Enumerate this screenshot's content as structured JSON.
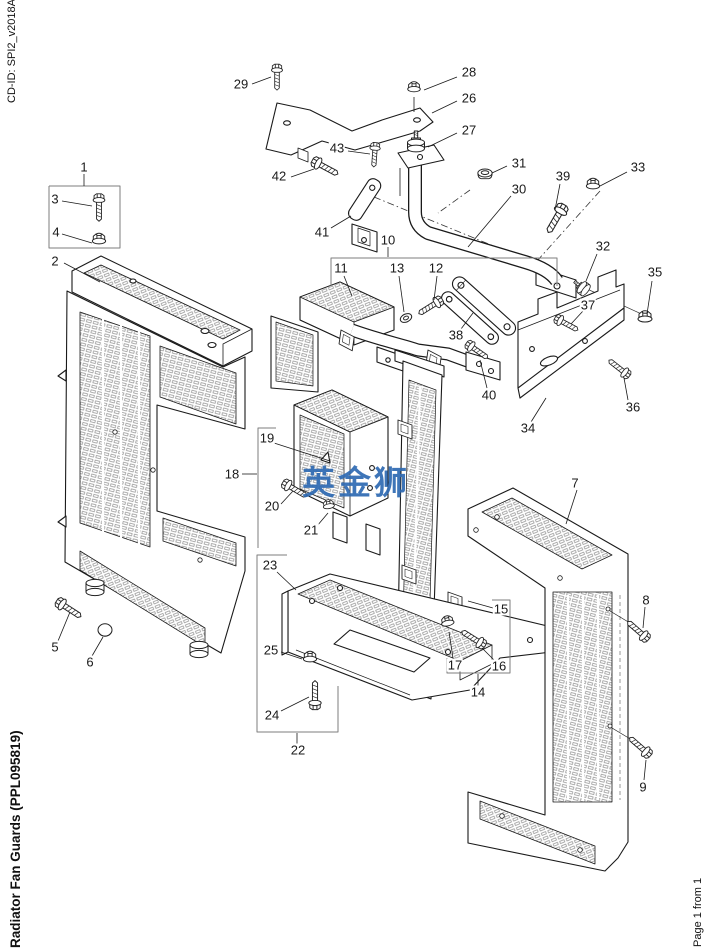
{
  "page": {
    "cd_id": "CD-ID: SPI2_v2018A",
    "title": "Radiator Fan Guards (PPL095819)",
    "page_label": "Page 1 from 1",
    "background": "#ffffff",
    "line_color": "#1a1a1a",
    "box_color": "#7d7d7d"
  },
  "watermark": {
    "text": "英金狮",
    "color": "#2e6ab3"
  },
  "diagram": {
    "description": "Exploded isometric parts diagram of radiator fan guards with numbered callouts 1-43",
    "callouts": [
      {
        "label": "1",
        "x": 84,
        "y": 167
      },
      {
        "label": "2",
        "x": 55,
        "y": 261
      },
      {
        "label": "3",
        "x": 55,
        "y": 199
      },
      {
        "label": "4",
        "x": 56,
        "y": 232
      },
      {
        "label": "5",
        "x": 55,
        "y": 647
      },
      {
        "label": "6",
        "x": 90,
        "y": 662
      },
      {
        "label": "7",
        "x": 575,
        "y": 483
      },
      {
        "label": "8",
        "x": 646,
        "y": 600
      },
      {
        "label": "9",
        "x": 643,
        "y": 787
      },
      {
        "label": "10",
        "x": 388,
        "y": 240
      },
      {
        "label": "11",
        "x": 341,
        "y": 268
      },
      {
        "label": "12",
        "x": 436,
        "y": 268
      },
      {
        "label": "13",
        "x": 397,
        "y": 268
      },
      {
        "label": "14",
        "x": 478,
        "y": 692
      },
      {
        "label": "15",
        "x": 501,
        "y": 609
      },
      {
        "label": "16",
        "x": 499,
        "y": 666
      },
      {
        "label": "17",
        "x": 455,
        "y": 665
      },
      {
        "label": "18",
        "x": 232,
        "y": 474
      },
      {
        "label": "19",
        "x": 267,
        "y": 438
      },
      {
        "label": "20",
        "x": 272,
        "y": 506
      },
      {
        "label": "21",
        "x": 311,
        "y": 530
      },
      {
        "label": "22",
        "x": 298,
        "y": 750
      },
      {
        "label": "23",
        "x": 270,
        "y": 565
      },
      {
        "label": "24",
        "x": 272,
        "y": 715
      },
      {
        "label": "25",
        "x": 271,
        "y": 650
      },
      {
        "label": "26",
        "x": 469,
        "y": 98
      },
      {
        "label": "27",
        "x": 469,
        "y": 130
      },
      {
        "label": "28",
        "x": 469,
        "y": 72
      },
      {
        "label": "29",
        "x": 241,
        "y": 84
      },
      {
        "label": "30",
        "x": 519,
        "y": 189
      },
      {
        "label": "31",
        "x": 519,
        "y": 163
      },
      {
        "label": "32",
        "x": 603,
        "y": 246
      },
      {
        "label": "33",
        "x": 638,
        "y": 167
      },
      {
        "label": "34",
        "x": 528,
        "y": 428
      },
      {
        "label": "35",
        "x": 655,
        "y": 272
      },
      {
        "label": "36",
        "x": 633,
        "y": 407
      },
      {
        "label": "37",
        "x": 588,
        "y": 305
      },
      {
        "label": "38",
        "x": 456,
        "y": 335
      },
      {
        "label": "39",
        "x": 563,
        "y": 176
      },
      {
        "label": "40",
        "x": 489,
        "y": 395
      },
      {
        "label": "41",
        "x": 322,
        "y": 232
      },
      {
        "label": "42",
        "x": 279,
        "y": 176
      },
      {
        "label": "43",
        "x": 337,
        "y": 148
      }
    ],
    "leaders": [
      [
        84,
        174,
        84,
        186
      ],
      [
        64,
        263,
        100,
        282
      ],
      [
        62,
        201,
        92,
        206
      ],
      [
        62,
        234,
        92,
        243
      ],
      [
        58,
        641,
        70,
        612
      ],
      [
        92,
        656,
        103,
        637
      ],
      [
        577,
        490,
        566,
        524
      ],
      [
        645,
        607,
        643,
        628
      ],
      [
        644,
        780,
        646,
        760
      ],
      [
        388,
        247,
        388,
        257
      ],
      [
        344,
        276,
        352,
        296
      ],
      [
        437,
        276,
        434,
        300
      ],
      [
        399,
        276,
        404,
        312
      ],
      [
        478,
        686,
        478,
        674
      ],
      [
        493,
        608,
        468,
        601
      ],
      [
        494,
        660,
        482,
        648
      ],
      [
        453,
        658,
        449,
        632
      ],
      [
        242,
        474,
        257,
        474
      ],
      [
        274,
        443,
        330,
        461
      ],
      [
        281,
        504,
        293,
        491
      ],
      [
        317,
        526,
        328,
        513
      ],
      [
        297,
        744,
        297,
        733
      ],
      [
        277,
        572,
        296,
        590
      ],
      [
        281,
        711,
        309,
        697
      ],
      [
        281,
        652,
        302,
        659
      ],
      [
        457,
        101,
        432,
        113
      ],
      [
        457,
        133,
        428,
        147
      ],
      [
        457,
        77,
        424,
        90
      ],
      [
        252,
        84,
        271,
        77
      ],
      [
        511,
        196,
        468,
        247
      ],
      [
        507,
        166,
        492,
        173
      ],
      [
        597,
        254,
        586,
        281
      ],
      [
        627,
        172,
        600,
        186
      ],
      [
        531,
        422,
        546,
        398
      ],
      [
        652,
        281,
        647,
        314
      ],
      [
        628,
        400,
        624,
        378
      ],
      [
        583,
        311,
        571,
        324
      ],
      [
        461,
        329,
        473,
        313
      ],
      [
        560,
        184,
        555,
        210
      ],
      [
        487,
        388,
        480,
        360
      ],
      [
        331,
        228,
        351,
        216
      ],
      [
        291,
        177,
        314,
        169
      ],
      [
        348,
        151,
        370,
        154
      ]
    ],
    "boxes": [
      {
        "points": "49,186 120,186 120,248 49,248 49,186"
      },
      {
        "points": "331,286 331,258 557,258 557,286"
      },
      {
        "points": "276,428 258,428 258,548"
      },
      {
        "points": "287,555 257,555 257,732 338,732 338,686"
      },
      {
        "points": "447,658 447,673 510,673 510,600 492,600"
      }
    ],
    "axes": [
      [
        374,
        197,
        552,
        270
      ],
      [
        600,
        191,
        537,
        261
      ],
      [
        470,
        190,
        438,
        213
      ],
      [
        572,
        282,
        648,
        317
      ]
    ]
  }
}
